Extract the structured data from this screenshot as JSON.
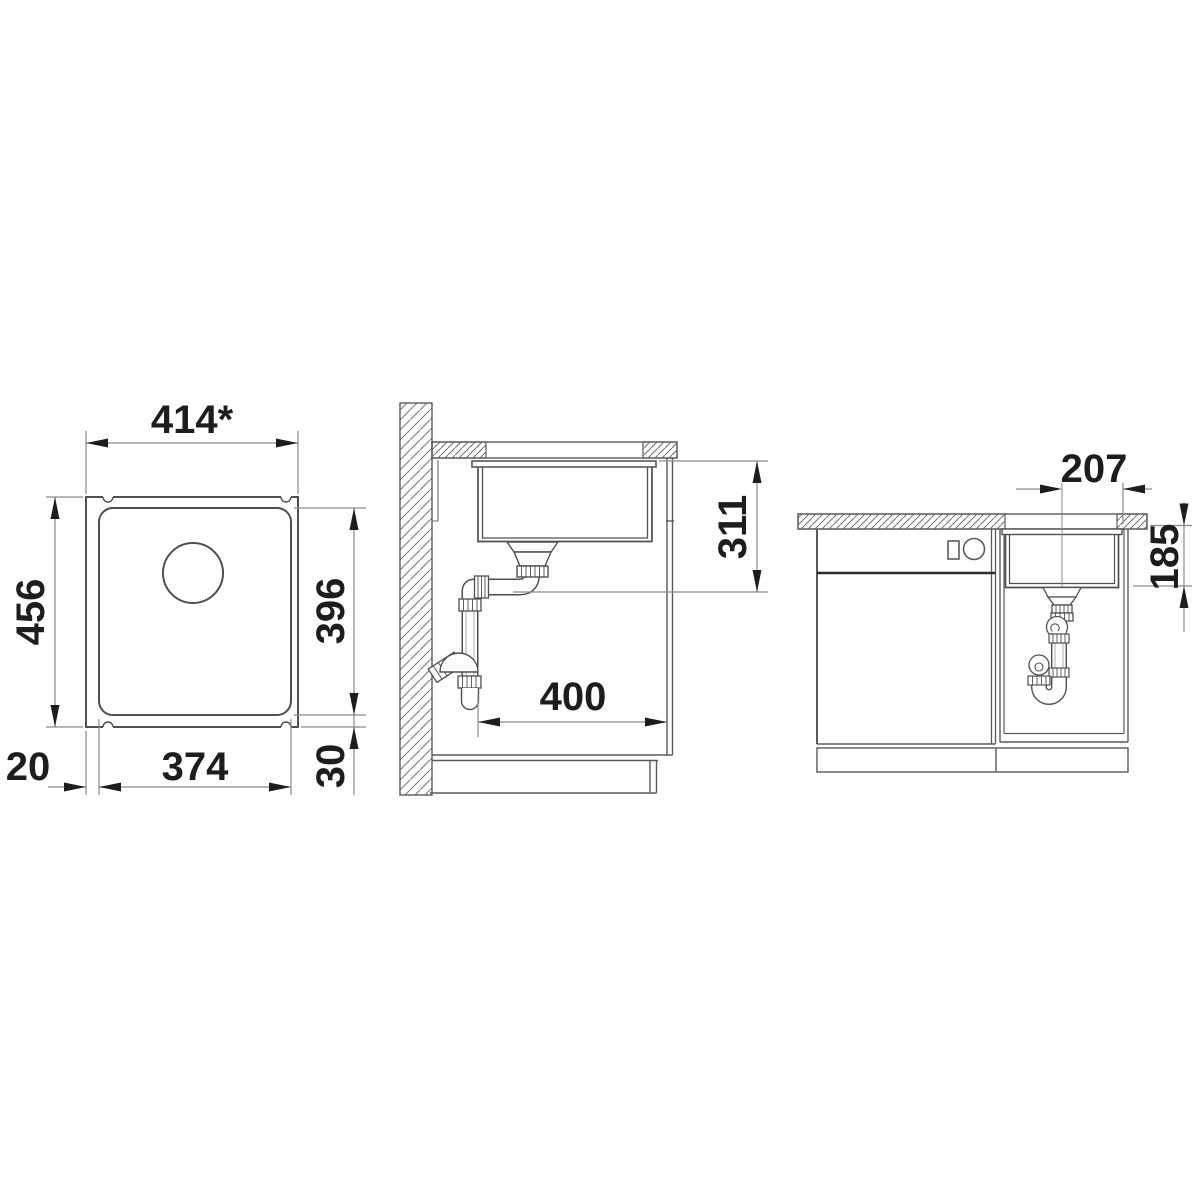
{
  "drawing": {
    "description": "sink-installation-dimension-drawing",
    "top_view": {
      "width_label": "414*",
      "depth_label": "456",
      "bowl_depth_label": "396",
      "bowl_width_label": "374",
      "rim_left_label": "20",
      "rim_bottom_label": "30"
    },
    "section_view": {
      "install_height_label": "311",
      "clearance_label": "400"
    },
    "front_view": {
      "drain_offset_label": "207",
      "bowl_depth_label": "185"
    },
    "colors": {
      "background": "#ffffff",
      "geometry_line": "#4f4f4f",
      "light_line": "#5a5a5a",
      "dim_line": "#8a8a8a",
      "text": "#1d1d1d",
      "dark_accent": "#2d2d2d"
    }
  }
}
